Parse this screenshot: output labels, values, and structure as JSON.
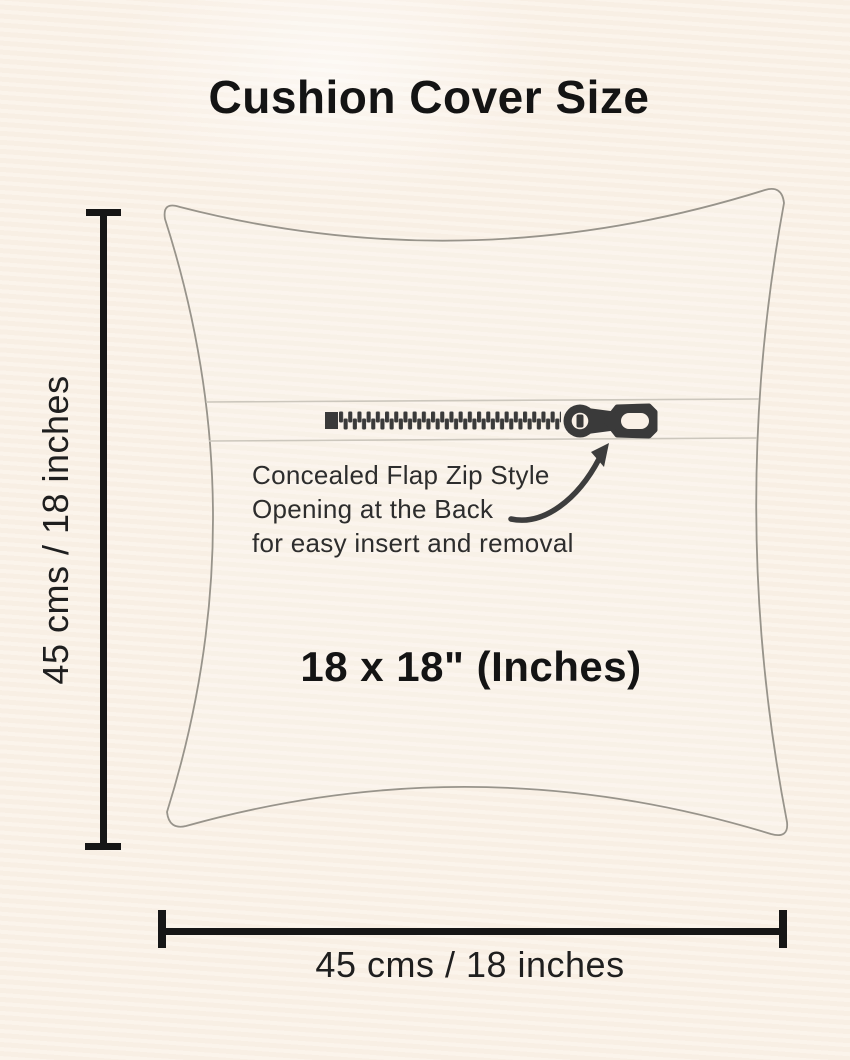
{
  "page": {
    "title": "Cushion Cover Size",
    "background_color": "#faf1e7"
  },
  "pillow": {
    "outline_color": "#98948b",
    "size_label": "18 x 18\" (Inches)"
  },
  "zipper": {
    "color": "#3a3a3a",
    "flap_line_color": "#ccc7bd",
    "note_line1": "Concealed Flap Zip Style",
    "note_line2": "Opening at the Back",
    "note_line3": "for easy insert and removal"
  },
  "dimensions": {
    "line_color": "#161616",
    "left_label": "45 cms / 18 inches",
    "bottom_label": "45 cms / 18 inches"
  }
}
